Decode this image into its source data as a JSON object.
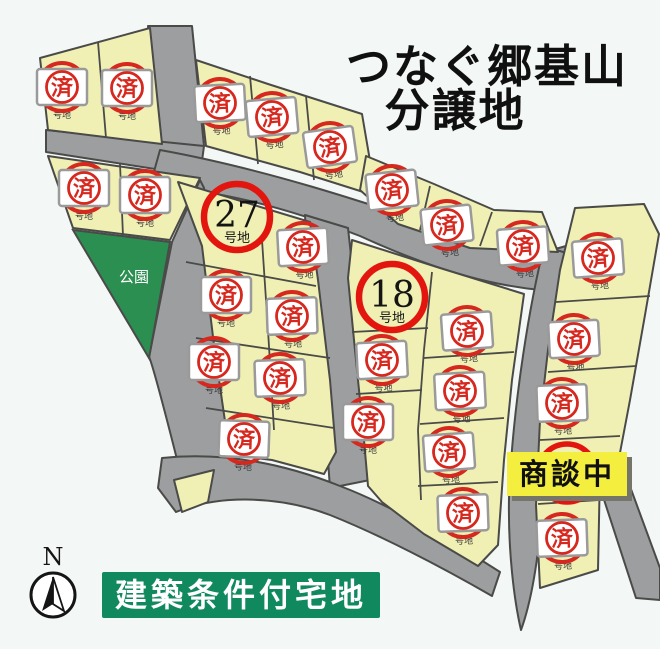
{
  "title": {
    "line1": "つなぐ郷基山",
    "line2": "分譲地"
  },
  "park": {
    "label": "公園",
    "x": 134,
    "y": 277
  },
  "legend": {
    "label": "建築条件付宅地"
  },
  "compass": {
    "label": "N",
    "x": 53,
    "y": 595
  },
  "negotiating": {
    "label": "商談中",
    "x": 567,
    "y": 474
  },
  "sold_stamp": {
    "label": "済",
    "sub_label": "号地"
  },
  "available_lots": [
    {
      "number": "27",
      "suffix": "号地",
      "x": 237,
      "y": 217
    },
    {
      "number": "18",
      "suffix": "号地",
      "x": 392,
      "y": 297
    }
  ],
  "sold_lots": [
    {
      "x": 62,
      "y": 87,
      "r": 0
    },
    {
      "x": 127,
      "y": 88,
      "r": 0
    },
    {
      "x": 220,
      "y": 103,
      "r": -3
    },
    {
      "x": 272,
      "y": 117,
      "r": -5
    },
    {
      "x": 330,
      "y": 147,
      "r": -8
    },
    {
      "x": 84,
      "y": 188,
      "r": 0
    },
    {
      "x": 145,
      "y": 195,
      "r": 0
    },
    {
      "x": 392,
      "y": 190,
      "r": -6
    },
    {
      "x": 447,
      "y": 225,
      "r": -6
    },
    {
      "x": 523,
      "y": 246,
      "r": -4
    },
    {
      "x": 598,
      "y": 258,
      "r": -4
    },
    {
      "x": 303,
      "y": 247,
      "r": -3
    },
    {
      "x": 226,
      "y": 295,
      "r": 0
    },
    {
      "x": 292,
      "y": 316,
      "r": -2
    },
    {
      "x": 214,
      "y": 362,
      "r": 0
    },
    {
      "x": 280,
      "y": 378,
      "r": -2
    },
    {
      "x": 244,
      "y": 439,
      "r": 2
    },
    {
      "x": 382,
      "y": 360,
      "r": -3
    },
    {
      "x": 467,
      "y": 331,
      "r": -4
    },
    {
      "x": 460,
      "y": 391,
      "r": -3
    },
    {
      "x": 368,
      "y": 422,
      "r": 0
    },
    {
      "x": 449,
      "y": 452,
      "r": -4
    },
    {
      "x": 463,
      "y": 513,
      "r": -2
    },
    {
      "x": 574,
      "y": 339,
      "r": -3
    },
    {
      "x": 562,
      "y": 403,
      "r": -2
    },
    {
      "x": 562,
      "y": 538,
      "r": -2
    }
  ],
  "counts": {
    "sold": 26,
    "available": 2,
    "negotiating": 1
  },
  "colors": {
    "bg": "#f3f7f5",
    "lot": "#f0f0b4",
    "lot_edge": "#4a4a48",
    "road": "#9c9ea0",
    "road_edge": "#4a4a48",
    "park": "#2c8f52",
    "stamp_red": "#d6281e",
    "box_edge": "#9a9a9a",
    "available_red": "#e3150f",
    "negotiating_bg": "#f4ee3e",
    "negotiating_shadow": "#75756a",
    "legend_bg": "#10895f",
    "title_color": "#101010"
  }
}
